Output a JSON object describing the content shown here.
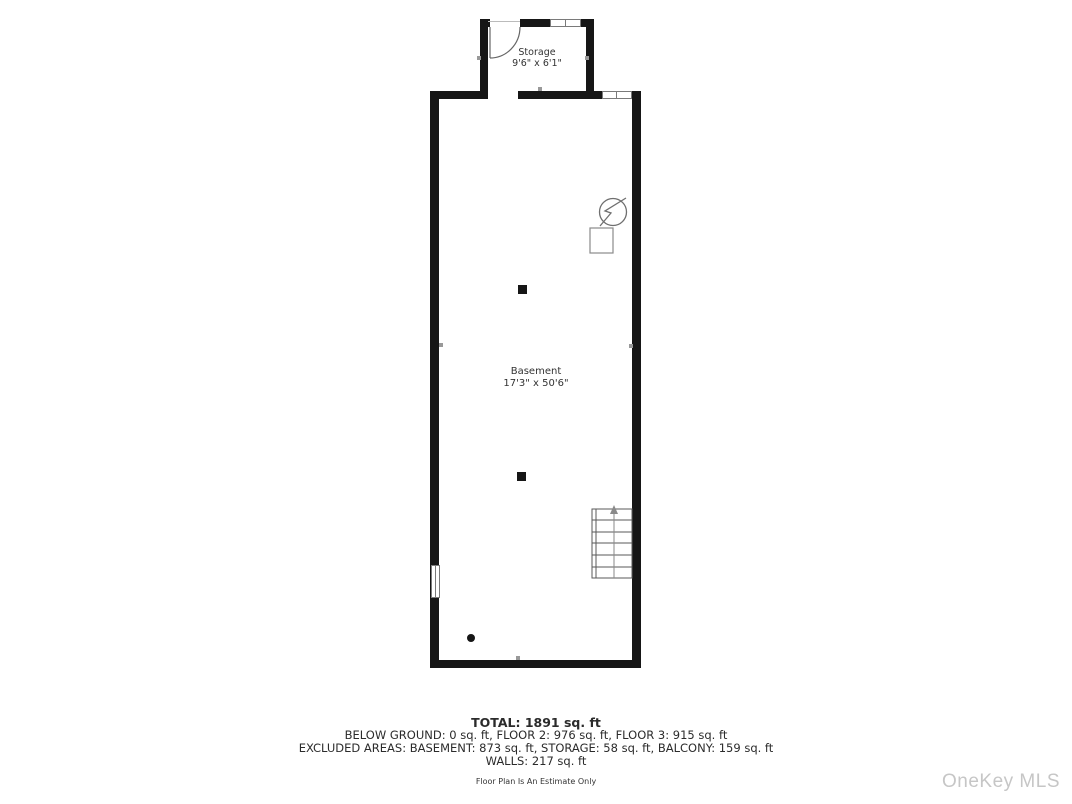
{
  "floor_plan": {
    "rooms": [
      {
        "name": "Storage",
        "dimensions": "9'6\" x 6'1\""
      },
      {
        "name": "Basement",
        "dimensions": "17'3\" x 50'6\""
      }
    ],
    "summary": {
      "total": "TOTAL: 1891 sq. ft",
      "floors": "BELOW GROUND: 0 sq. ft, FLOOR 2: 976 sq. ft, FLOOR 3: 915 sq. ft",
      "excluded": "EXCLUDED AREAS: BASEMENT: 873 sq. ft, STORAGE: 58 sq. ft, BALCONY: 159 sq. ft",
      "walls": "WALLS: 217 sq. ft",
      "disclaimer": "Floor Plan Is An Estimate Only"
    },
    "watermark": "OneKey MLS",
    "icons": [
      "door-swing-icon",
      "electrical-panel-icon",
      "utility-box-icon",
      "staircase-icon",
      "window-icon",
      "support-column-icon",
      "drain-dot-icon"
    ],
    "colors": {
      "wall": "#161616",
      "text": "#2b2b2b",
      "thin_line": "#777777",
      "watermark": "#c6c6c6"
    }
  }
}
